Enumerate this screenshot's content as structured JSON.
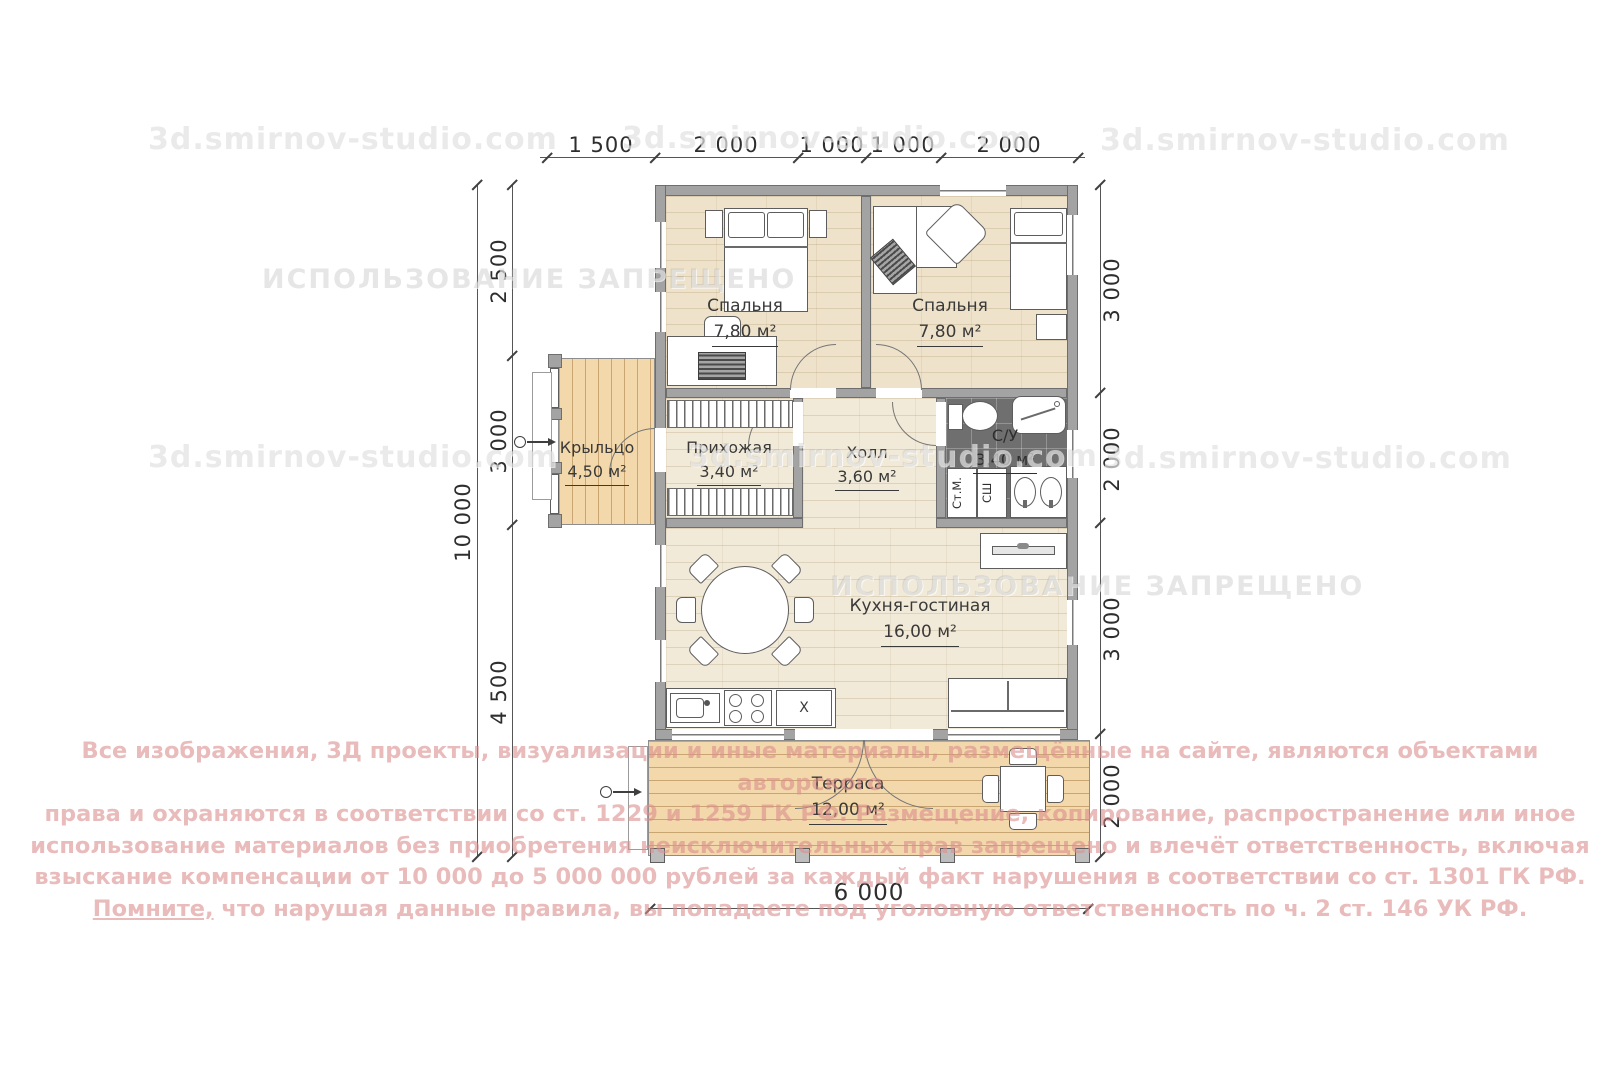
{
  "watermarks": {
    "site": "3d.smirnov-studio.com",
    "forbidden": "ИСПОЛЬЗОВАНИЕ ЗАПРЕЩЕНО"
  },
  "copyright": {
    "line1": "Все изображения, 3Д проекты, визуализации и иные материалы, размещённые на сайте, являются объектами авторского",
    "line2": "права и охраняются в соответствии со ст. 1229 и 1259 ГК РФ. Размещение, копирование, распространение или иное",
    "line3": "использование материалов без приобретения неисключительных прав запрещено и влечёт ответственность, включая",
    "line4": "взыскание компенсации от 10 000 до 5 000 000 рублей за каждый факт нарушения в соответствии со ст. 1301 ГК РФ.",
    "line5_lead": "Помните,",
    "line5_rest": " что нарушая данные правила, вы попадаете под уголовную ответственность по ч. 2 ст. 146 УК РФ."
  },
  "rooms": {
    "bedroom1": {
      "name": "Спальня",
      "area": "7,80 м²"
    },
    "bedroom2": {
      "name": "Спальня",
      "area": "7,80 м²"
    },
    "porch": {
      "name": "Крыльцо",
      "area": "4,50 м²"
    },
    "hallway": {
      "name": "Прихожая",
      "area": "3,40 м²"
    },
    "hall": {
      "name": "Холл",
      "area": "3,60 м²"
    },
    "bathroom": {
      "name": "С/У",
      "area": "3,40 м²"
    },
    "kitchen": {
      "name": "Кухня-гостиная",
      "area": "16,00 м²"
    },
    "terrace": {
      "name": "Терраса",
      "area": "12,00 м²"
    }
  },
  "appliances": {
    "washing_machine": "Ст.М.",
    "dryer": "СШ",
    "cabinet": "X"
  },
  "dimensions": {
    "top": [
      "1 500",
      "2 000",
      "1 000",
      "1 000",
      "2 000"
    ],
    "left_total": "10 000",
    "left": [
      "2 500",
      "3 000",
      "4 500"
    ],
    "right": [
      "3 000",
      "2 000",
      "3 000",
      "2 000"
    ],
    "bottom": "6 000"
  }
}
